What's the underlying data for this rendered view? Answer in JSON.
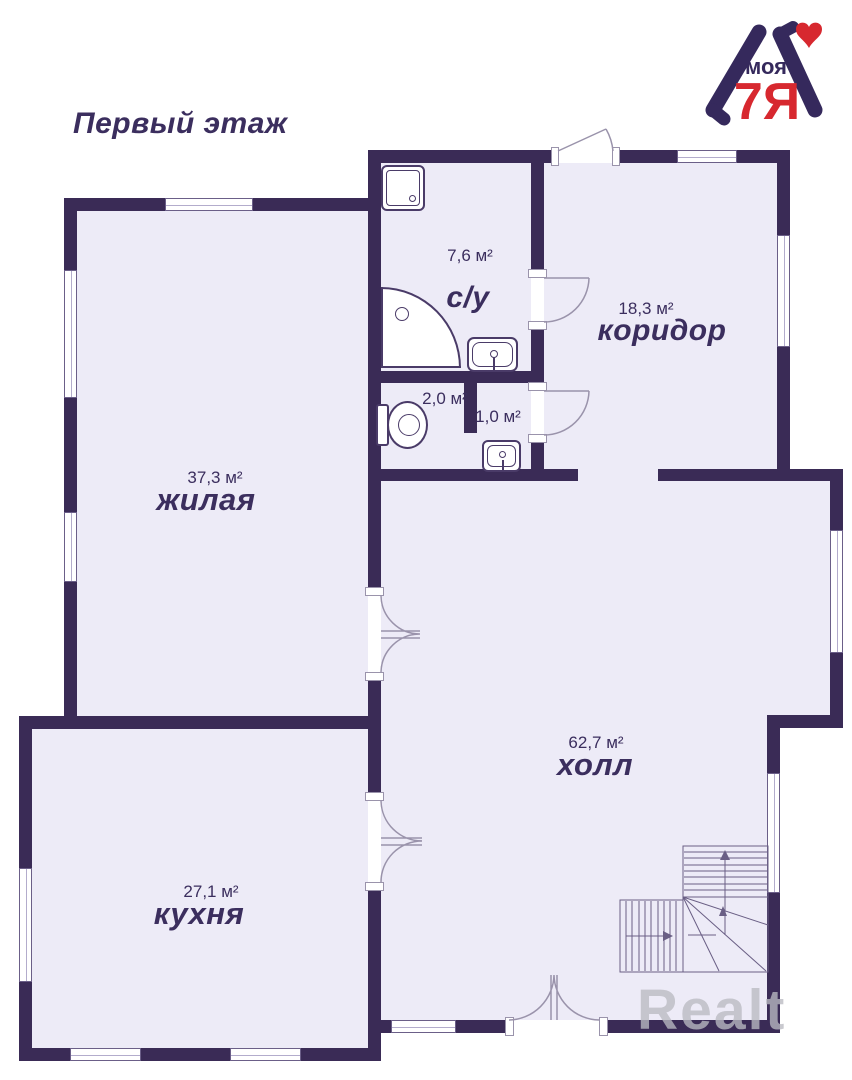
{
  "page": {
    "title": "Первый этаж",
    "watermark": "Realt"
  },
  "logo": {
    "top_word": "моя",
    "bottom_word": "7Я"
  },
  "colors": {
    "wall": "#3a2b56",
    "floor": "#edebf7",
    "ink": "#3b2e5e",
    "accent": "#d7282f",
    "watermark": "rgba(186,186,194,0.78)"
  },
  "rooms": [
    {
      "id": "bathroom",
      "name": "с/у",
      "area": "7,6 м²"
    },
    {
      "id": "wc",
      "name": "",
      "area": "2,0 м²"
    },
    {
      "id": "lavatory",
      "name": "",
      "area": "1,0 м²"
    },
    {
      "id": "corridor",
      "name": "коридор",
      "area": "18,3 м²"
    },
    {
      "id": "living",
      "name": "жилая",
      "area": "37,3 м²"
    },
    {
      "id": "hall",
      "name": "холл",
      "area": "62,7 м²"
    },
    {
      "id": "kitchen",
      "name": "кухня",
      "area": "27,1 м²"
    }
  ]
}
